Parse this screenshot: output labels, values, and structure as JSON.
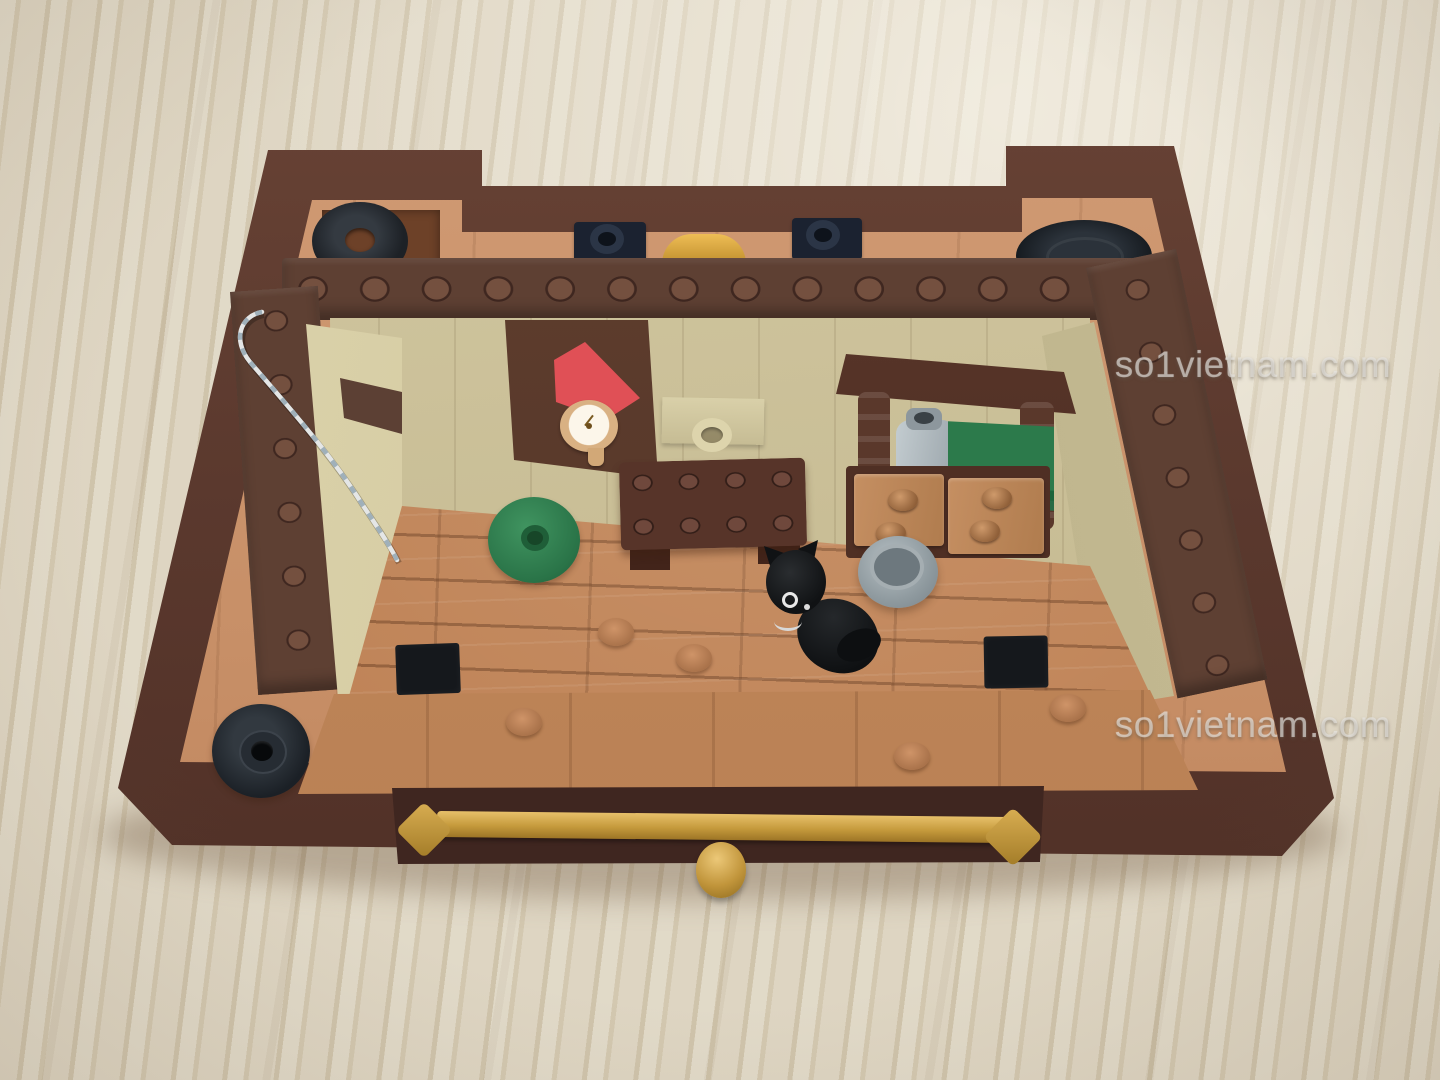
{
  "scene": {
    "description": "Top-down photo of a LEGO miniature room interior build standing on a light wooden table",
    "watermark": {
      "text": "so1vietnam.com"
    },
    "colors": {
      "wood_table": "#d9cfb9",
      "brick_dark_brown": "#5b3a2f",
      "plate_nougat": "#c99470",
      "wall_tan": "#cdc39c",
      "floor_nougat": "#bf8357",
      "accent_red": "#c63a40",
      "accent_green": "#2c7a4b",
      "accent_gold": "#c59a3c",
      "pot_gray": "#9aa5ab",
      "piece_black": "#1a1f24"
    },
    "objects": [
      "outer brick frame",
      "studded wall ring",
      "tan interior walls",
      "brick-tiled floor",
      "black cat figure",
      "gray pot",
      "green round rug",
      "dark brown table",
      "cuckoo clock with red roof",
      "wall hook",
      "shelf hutch with bottle and green book",
      "drawer chest",
      "silver string over wall",
      "black pulley wheel",
      "black donut tile",
      "black tire",
      "gold drawer rail with knob"
    ]
  }
}
